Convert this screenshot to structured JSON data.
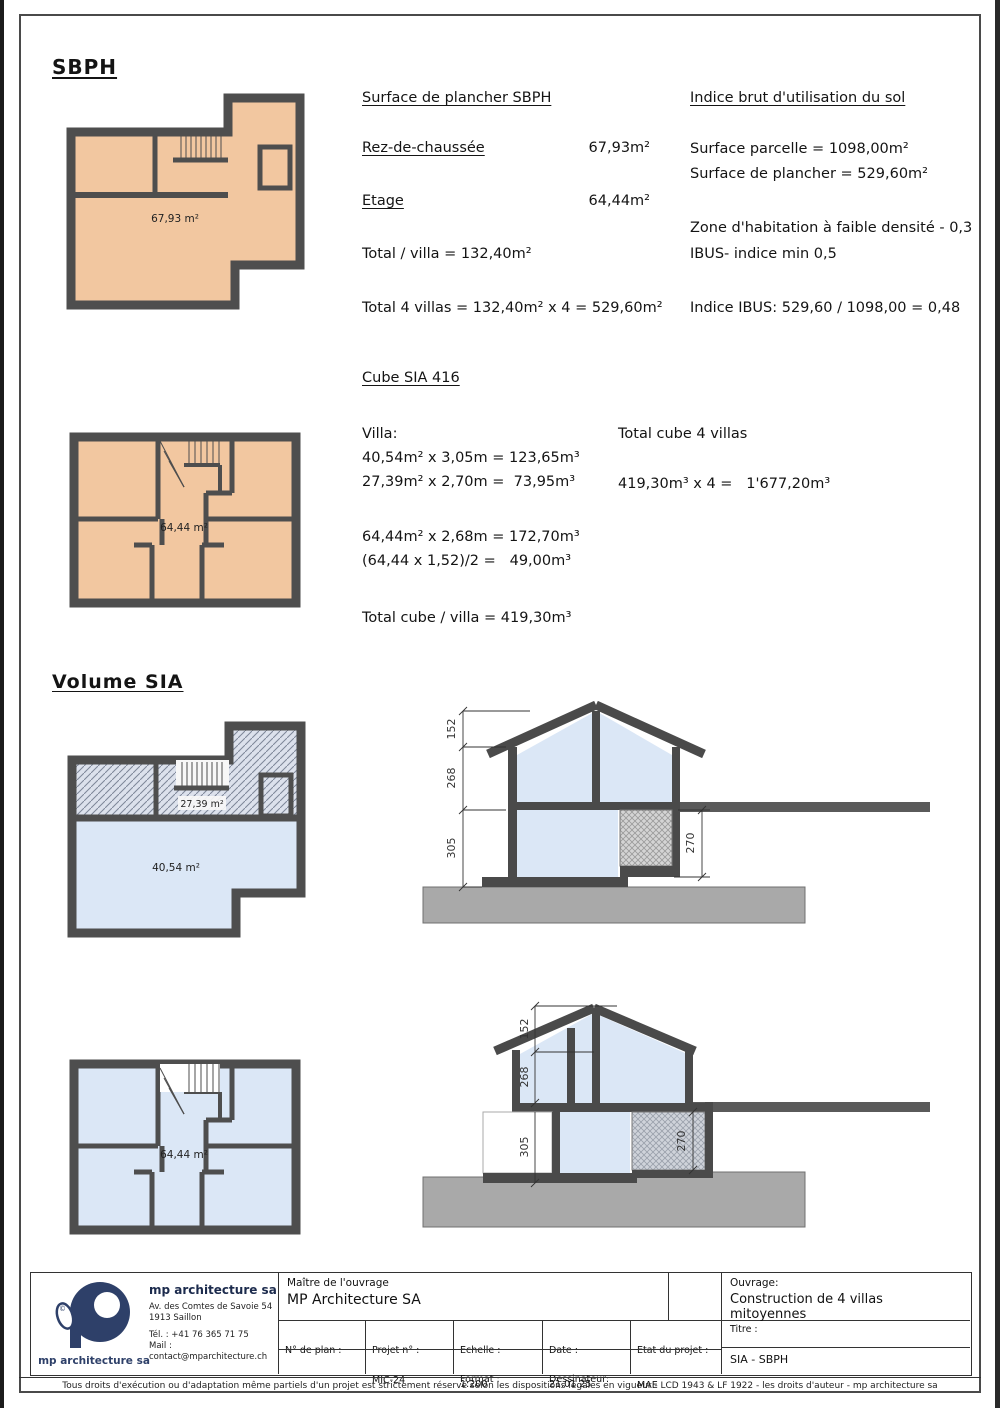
{
  "sheet": {
    "sbph_title": "SBPH",
    "volume_title": "Volume SIA"
  },
  "surface": {
    "title": "Surface de plancher SBPH",
    "rows": [
      {
        "label": "Rez-de-chaussée",
        "value": "67,93m²"
      },
      {
        "label": "Etage",
        "value": "64,44m²"
      }
    ],
    "total_villa": "Total / villa = 132,40m²",
    "total_4_villas": "Total 4 villas = 132,40m² x 4 = 529,60m²"
  },
  "indice": {
    "title": "Indice brut d'utilisation du sol",
    "line1": "Surface parcelle = 1098,00m²",
    "line2": "Surface de plancher = 529,60m²",
    "line3": "Zone d'habitation à faible densité - 0,3",
    "line4": "IBUS- indice min 0,5",
    "result": "Indice IBUS: 529,60 / 1098,00 = 0,48"
  },
  "cube": {
    "title": "Cube SIA 416",
    "villa_label": "Villa:",
    "line1": "40,54m² x 3,05m = 123,65m³",
    "line2": "27,39m² x 2,70m =  73,95m³",
    "line3": "64,44m² x 2,68m = 172,70m³",
    "line4": "(64,44 x 1,52)/2 =   49,00m³",
    "total": "Total cube / villa = 419,30m³",
    "total4_title": "Total cube 4 villas",
    "total4_line": "419,30m³ x 4 =   1'677,20m³"
  },
  "plans": {
    "rdc_area": "67,93 m²",
    "etage_area": "64,44 m²",
    "sia_upper_area": "27,39 m²",
    "sia_lower_area": "40,54 m²",
    "etage_sia_area": "64,44 m²"
  },
  "sections": {
    "dim_roof": "152",
    "dim_upper": "268",
    "dim_lower": "305",
    "dim_right": "270"
  },
  "titleblock": {
    "company": {
      "name": "mp architecture sa",
      "address1": "Av. des Comtes de Savoie 54",
      "address2": "1913 Saillon",
      "phone": "Tél. : +41 76 365 71 75",
      "mail": "Mail : contact@mparchitecture.ch",
      "logo_caption": "mp architecture sa",
      "logo_copyright": "©"
    },
    "maitre_label": "Maître de l'ouvrage",
    "maitre_value": "MP Architecture SA",
    "ouvrage_label": "Ouvrage:",
    "ouvrage_value": "Construction de 4 villas mitoyennes",
    "plan_no_label": "N° de plan :",
    "projet_label": "Projet n° :",
    "projet_value": "MIC-24",
    "echelle_label": "Echelle :",
    "echelle_value": "1:200",
    "format_label": "Format :",
    "format_value": "A4  210 / 297 mm",
    "date_label": "Date :",
    "date_value": "21.01.25",
    "dessinateur_label": "Dessinateur:",
    "dessinateur_value": "—",
    "etat_label": "Etat du projet :",
    "etat_value": "MAE",
    "titre_label": "Titre :",
    "titre_value": "SIA - SBPH"
  },
  "footer": "Tous droits d'exécution ou d'adaptation même partiels d'un projet est strictement réservé selon les dispositions légales en vigueur - LCD 1943 & LF 1922 -  les droits d'auteur  - mp architecture sa"
}
